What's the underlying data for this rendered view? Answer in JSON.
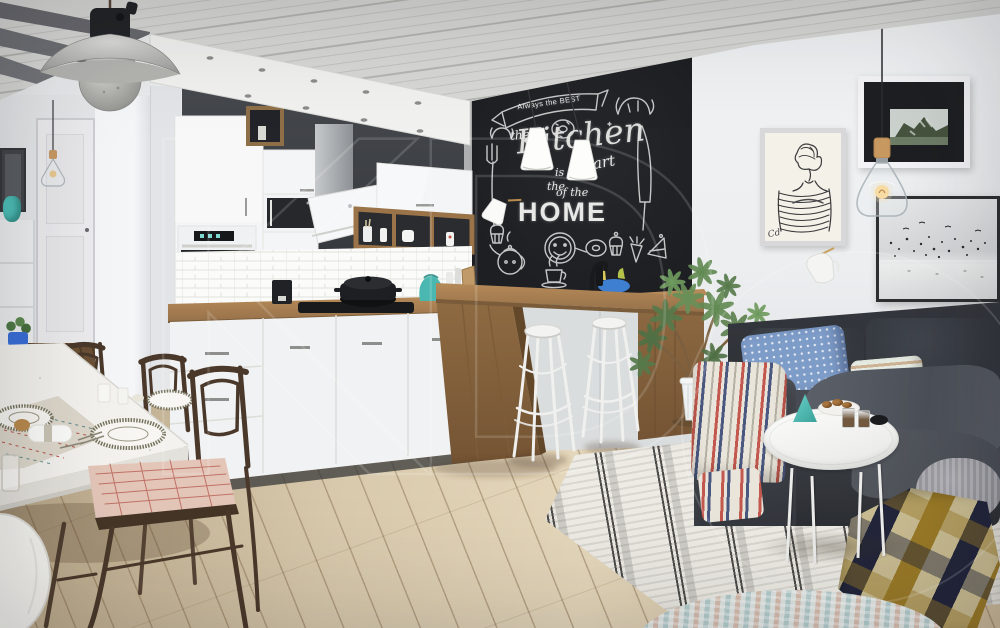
{
  "meta": {
    "description": "Scandinavian interior render: white kitchen with chalkboard wall, dining set, bar stools and charcoal sofa"
  },
  "watermark": {
    "text": "KD"
  },
  "chalkboard": {
    "banner": "Always the BEST",
    "the1": "the",
    "kitchen": "Kitchen",
    "is": "is",
    "the2": "the",
    "heart": "Heart",
    "of_the": "of the",
    "home": "HOME",
    "doodles": [
      "banner-ribbon-icon",
      "fork-icon",
      "knife-icon",
      "croissant-icon",
      "donut-icon",
      "smiley-face-icon",
      "cupcake-icon",
      "teapot-icon",
      "coffee-cup-icon",
      "carrot-icon",
      "cake-slice-icon"
    ]
  },
  "artwork": {
    "sketch_signature": "Cd"
  },
  "colors": {
    "wall": "#e9eaec",
    "ceiling": "#d8d8d6",
    "soffit": "#f1f1f0",
    "dark_wall": "#3c3f44",
    "board": "#1e1f23",
    "chalk": "#e8e8e6",
    "cabinet": "#f4f5f6",
    "wood": "#a87f52",
    "wood_dark": "#8a6842",
    "floor": "#d5c5a8",
    "sofa": "#34373d",
    "pillow_blue": "#7e9cc8",
    "rug": "#edebe4",
    "plaid_gold": "#9a7a28",
    "plaid_navy": "#23263b",
    "plaid_tan": "#c9bc92",
    "plant": "#5d8050",
    "chair": "#4a392b",
    "table": "#f3f2ee",
    "teal": "#4fc0b8",
    "throw_red": "#c2584e",
    "throw_navy": "#4a5880",
    "frame_black": "#2e2f31",
    "metal": "#97979a"
  }
}
